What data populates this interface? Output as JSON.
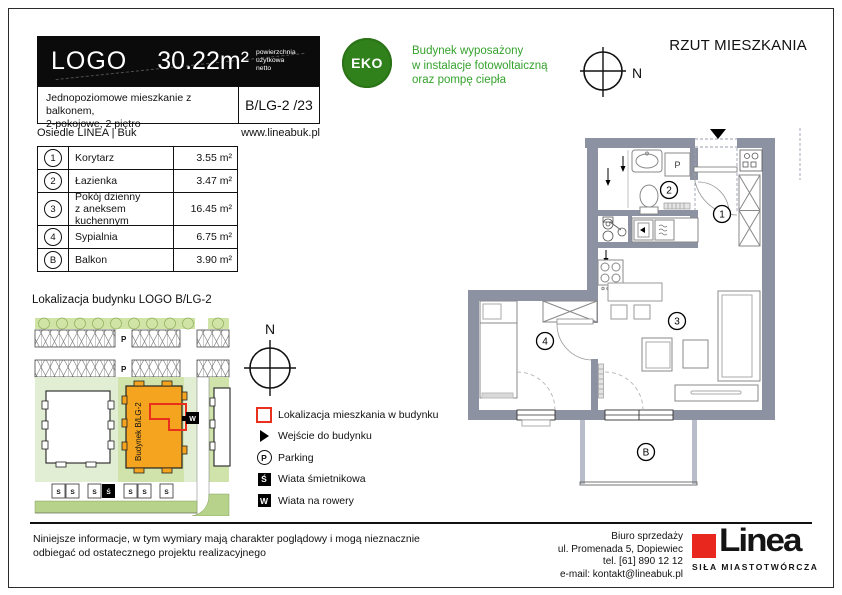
{
  "header": {
    "logo": "LOGO",
    "area_value": "30.22",
    "area_unit": "m²",
    "caption1": "powierzchnia",
    "caption2": "użytkowa",
    "caption3": "netto",
    "desc_line1": "Jednopoziomowe mieszkanie z balkonem,",
    "desc_line2": "2-pokojowe, 2 piętro",
    "unit_code": "B/LG-2 /23",
    "estate": "Osiedle LINEA | Buk",
    "website": "www.lineabuk.pl"
  },
  "eco": {
    "badge": "EKO",
    "line1": "Budynek wyposażony",
    "line2": "w instalacje fotowoltaiczną",
    "line3": "oraz pompę ciepła"
  },
  "plan": {
    "title": "RZUT MIESZKANIA"
  },
  "compass": {
    "n": "N"
  },
  "rooms": {
    "rows": [
      {
        "id": "1",
        "name": "Korytarz",
        "name2": "",
        "area": "3.55 m²"
      },
      {
        "id": "2",
        "name": "Łazienka",
        "name2": "",
        "area": "3.47 m²"
      },
      {
        "id": "3",
        "name": "Pokój dzienny",
        "name2": "z aneksem kuchennym",
        "area": "16.45 m²"
      },
      {
        "id": "4",
        "name": "Sypialnia",
        "name2": "",
        "area": "6.75 m²"
      },
      {
        "id": "B",
        "name": "Balkon",
        "name2": "",
        "area": "3.90 m²"
      }
    ]
  },
  "site": {
    "title": "Lokalizacja budynku LOGO B/LG-2",
    "building_label": "Budynek B/LG-2",
    "p": "P",
    "w": "W",
    "s": "S",
    "s_black": "Ś"
  },
  "legend": {
    "items": [
      {
        "glyph": "",
        "label": "Lokalizacja mieszkania w budynku"
      },
      {
        "glyph": "",
        "label": "Wejście do budynku"
      },
      {
        "glyph": "P",
        "label": "Parking"
      },
      {
        "glyph": "Ś",
        "label": "Wiata śmietnikowa"
      },
      {
        "glyph": "W",
        "label": "Wiata na rowery"
      }
    ]
  },
  "floor": {
    "washer_label": "P"
  },
  "footer": {
    "disclaimer1": "Niniejsze informacje, w tym wymiary mają charakter poglądowy i mogą nieznacznie",
    "disclaimer2": "odbiegać od ostatecznego projektu realizacyjnego",
    "office1": "Biuro sprzedaży",
    "office2": "ul. Promenada 5, Dopiewiec",
    "office3": "tel. [61] 890 12 12",
    "office4": "e-mail: kontakt@lineabuk.pl",
    "brand_name": "Linea",
    "brand_tagline": "SIŁA MIASTOTWÓRCZA"
  },
  "colors": {
    "eco_green": "#30801c",
    "text_green": "#35a22c",
    "wall_gray": "#8c92a2",
    "building_orange": "#f4a41f",
    "highlight_red": "#e8301c",
    "brand_red": "#e8281e"
  }
}
